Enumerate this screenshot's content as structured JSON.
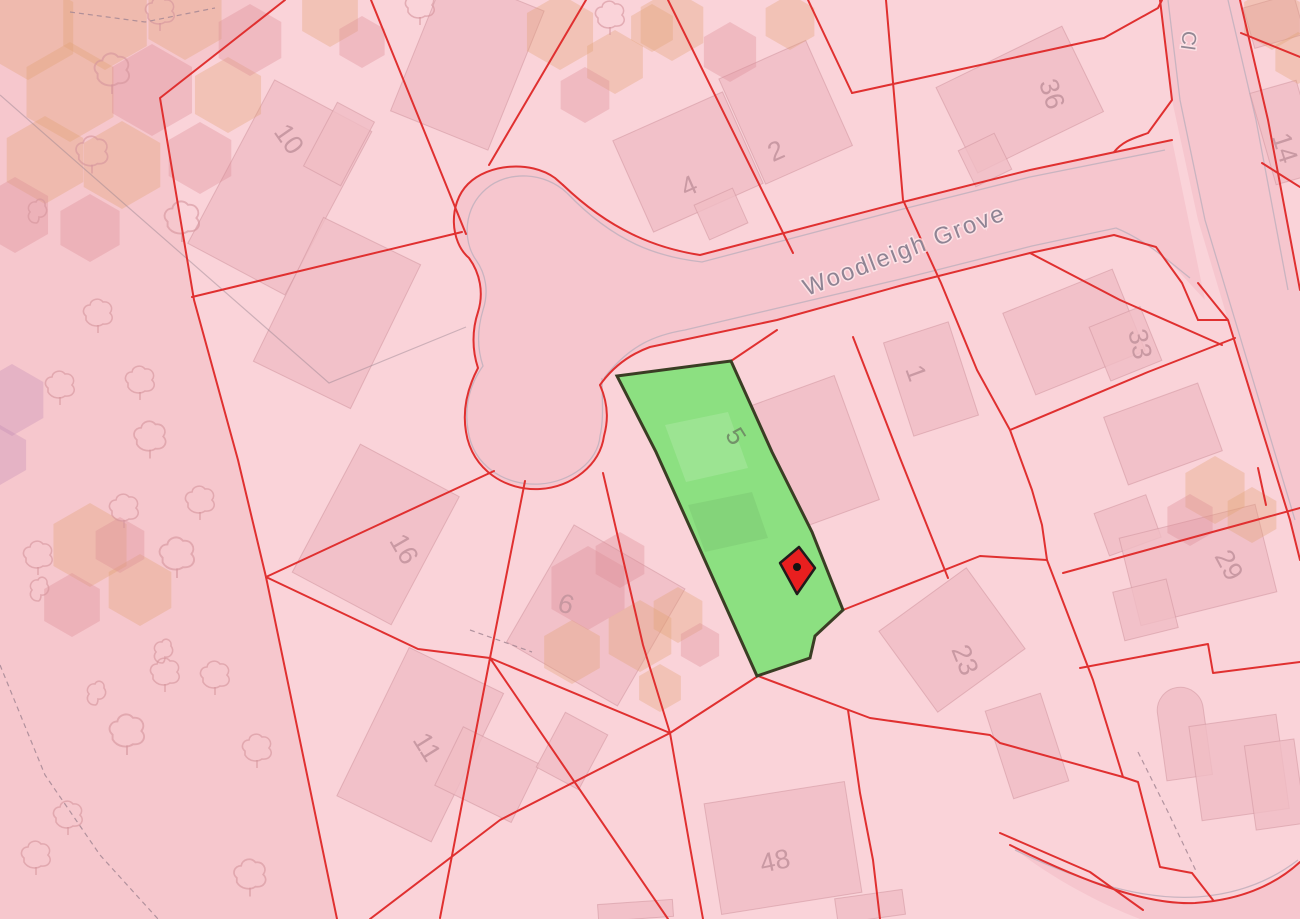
{
  "map": {
    "streets": {
      "woodleigh_grove": "Woodleigh Grove",
      "close_partial": "Cl"
    },
    "plot_numbers": {
      "n10": "10",
      "n4": "4",
      "n2": "2",
      "n36": "36",
      "n14": "14",
      "n33": "33",
      "n29": "29",
      "n16": "16",
      "n6": "6",
      "n11": "11",
      "n1": "1",
      "n5": "5",
      "n23": "23",
      "n48": "48"
    },
    "highlight": {
      "plot_label": "5"
    },
    "colors": {
      "parcel_pink": "#fad3d9",
      "woodland_pink": "#f6c7cd",
      "road_pink": "#f6c6ce",
      "building_pink": "#f0bdc4",
      "boundary_red": "#e03030",
      "highlight_green": "#8ce081",
      "highlight_outline": "#3a3d24",
      "marker_red": "#e81f1f",
      "marker_outline": "#1f1b1b"
    }
  }
}
